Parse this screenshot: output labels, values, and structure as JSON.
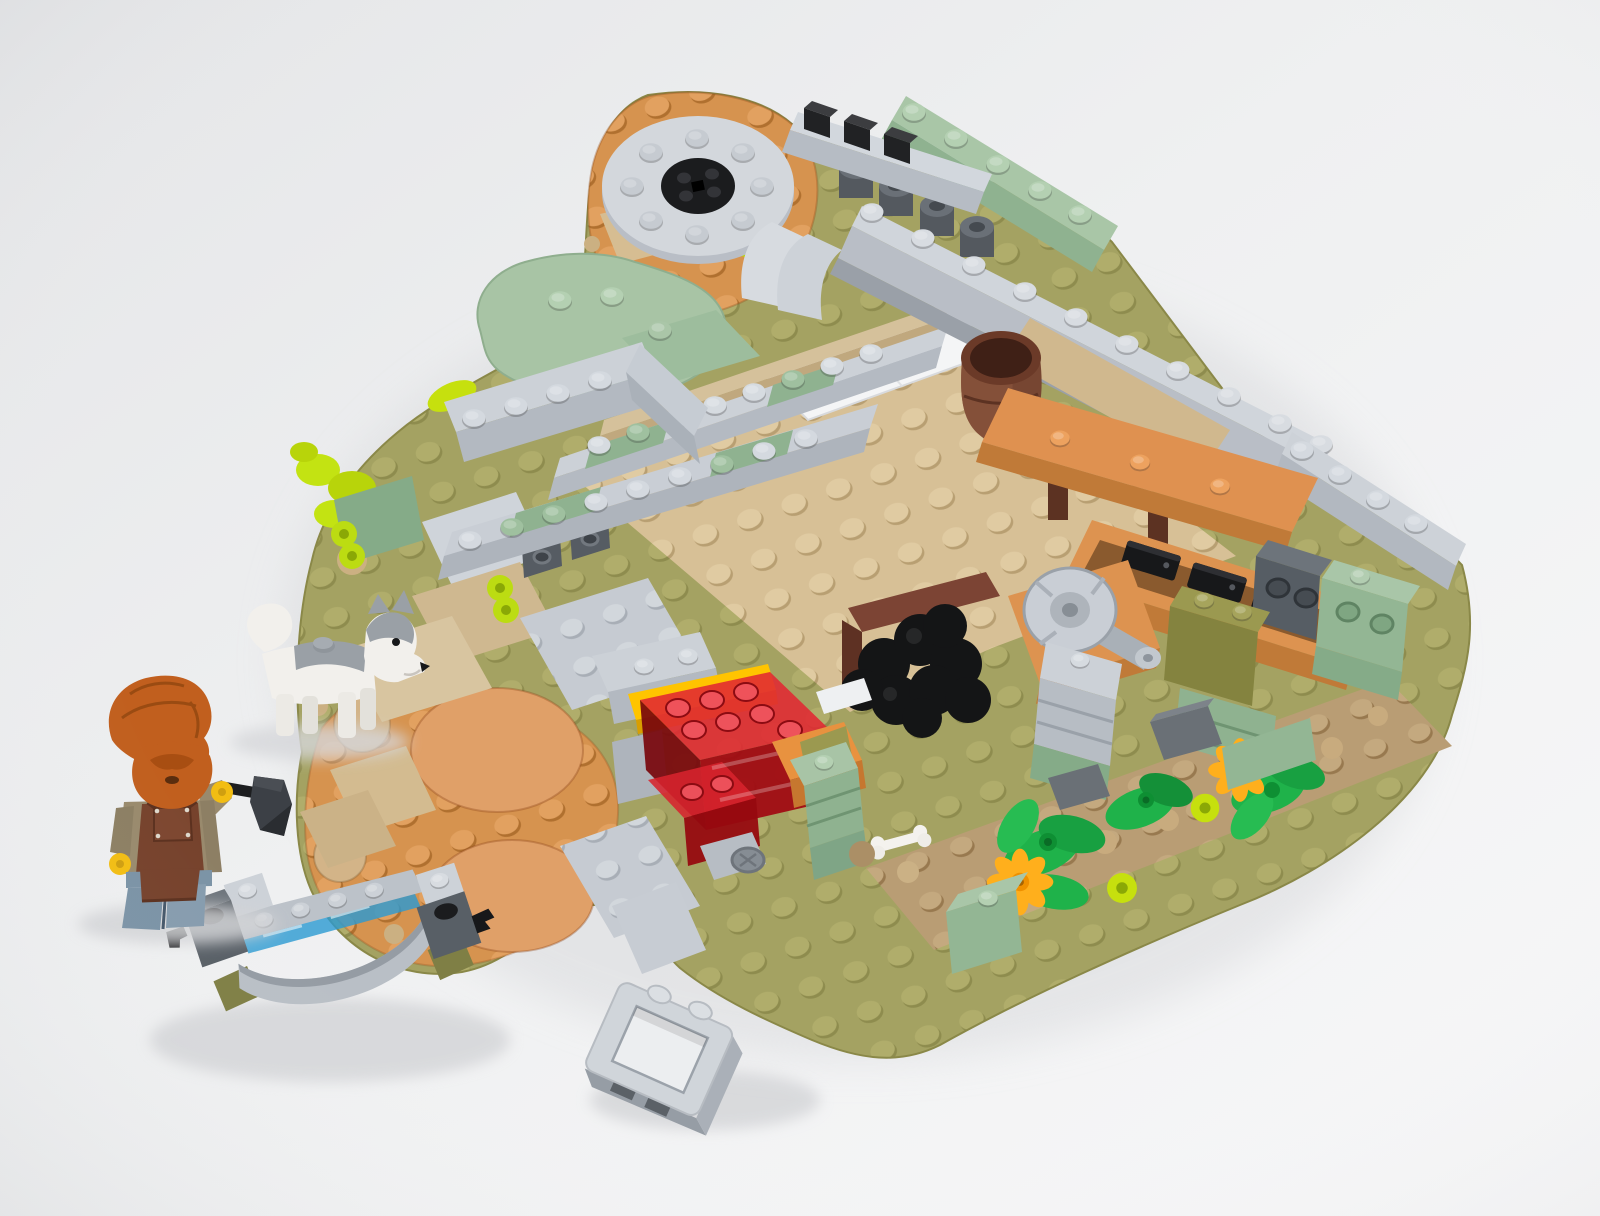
{
  "scene": {
    "description": "Angled studio photograph of a partially built LEGO medieval blacksmith yard on a white background: a bearded blacksmith minifigure with a hammer, a husky dog, an irregular olive-green baseplate with tan courtyard, a forge of transparent red bricks, a coal pile, an orange workbench with grindstone, a barrel, low gray stone wall footprints, a flower bed, a loose gray arch bridge over transparent blue water, and a loose window-frame brick",
    "objects": [
      {
        "name": "blacksmith-minifigure",
        "details": "orange hair and full beard, yellow face, dark tan shirt, reddish-brown work apron, sand-blue legs, yellow hands, holds a black hammer"
      },
      {
        "name": "husky-dog",
        "details": "white sled dog with gray back and head markings, one stud on its back"
      },
      {
        "name": "baseplate",
        "details": "irregular rounded olive-green plate with studs, joined to two orange round dirt plates"
      },
      {
        "name": "courtyard",
        "details": "large tan studded plate framed by light-gray and sand-green brick wall footprints"
      },
      {
        "name": "forge",
        "details": "cluster of transparent red fire bricks over a yellow and an orange plate, with a light-gray bellows nozzle"
      },
      {
        "name": "coal-pile",
        "details": "heap of black round tiles beside reddish-brown plank edges and a small white bone"
      },
      {
        "name": "workbench",
        "details": "orange bench along the gray wall with a light-gray grindstone wheel and black tools in a tray"
      },
      {
        "name": "barrel",
        "details": "reddish-brown barrel standing at the wall corner"
      },
      {
        "name": "millstone",
        "details": "round light-gray plate with black center pieces on the upper orange round plate"
      },
      {
        "name": "flower-bed",
        "details": "dark tan strip with bright green leaves, two yellow daisy flowers, lime buds and dark-gray rocks"
      },
      {
        "name": "bridge-assembly",
        "details": "loose light-gray arch bridge over transparent blue water tiles, dark-gray ends with black clips and olive feet"
      },
      {
        "name": "window-frame-piece",
        "details": "loose light-bluish-gray 1x2x2 window frame brick lying at the bottom edge"
      },
      {
        "name": "greenery",
        "details": "lime leaf pieces and bushes along the left edge, sand-green rock mound at the top"
      }
    ]
  },
  "palette": {
    "background": "#eef0f2",
    "olive_green": "#a4a262",
    "tan": "#d7c096",
    "dark_tan": "#b99d74",
    "orange_nougat": "#d6934f",
    "round_tile_nougat": "#e0a068",
    "bench_orange": "#df9150",
    "light_gray": "#c6cbd2",
    "dark_gray": "#5d646b",
    "black": "#1b1c1e",
    "sand_green": "#9fc09f",
    "sand_green_masonry": "#85ab88",
    "olive_brick": "#90904f",
    "trans_red": "#d01c28",
    "trans_blue": "#2a9ad2",
    "yellow_plate": "#ffc400",
    "reddish_brown": "#76422c",
    "barrel_brown": "#774632",
    "bright_green": "#1fb24a",
    "flower_yellow": "#ffaf1c",
    "lime": "#c6e00e",
    "sand_blue": "#7b93a6",
    "hair_orange": "#c15f1e",
    "skin_yellow": "#f6c50f",
    "shirt_dark_tan": "#998a6d",
    "white_piece": "#f1efeb"
  }
}
